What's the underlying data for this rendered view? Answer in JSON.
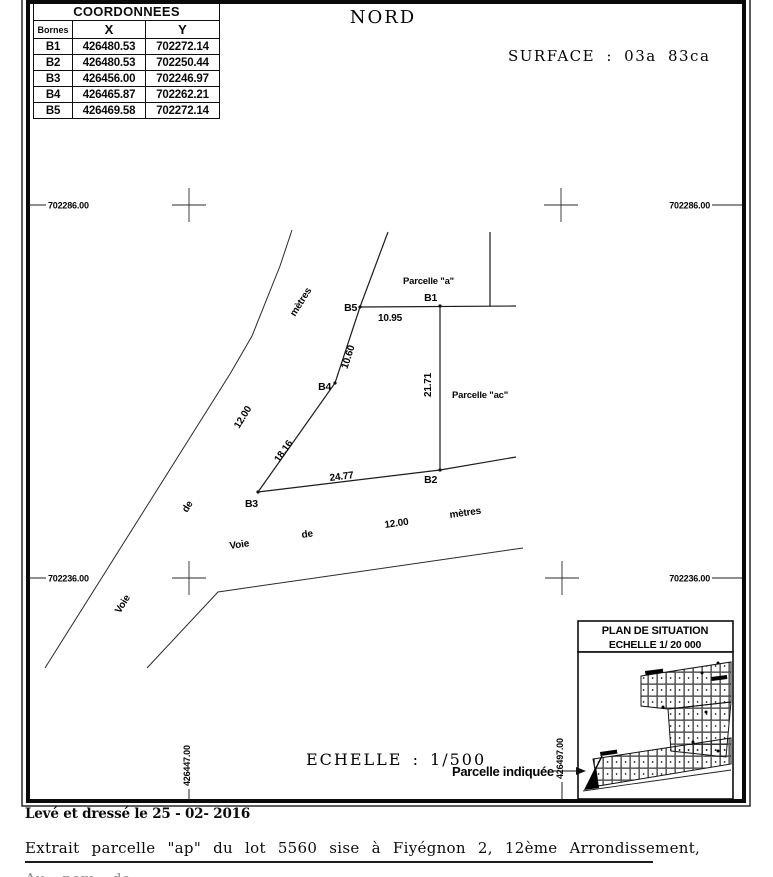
{
  "document": {
    "north_label": "NORD",
    "surface_label": "SURFACE : 03a 83ca",
    "scale_label": "ECHELLE : 1/500"
  },
  "coordinates_table": {
    "title": "COORDONNEES",
    "columns": [
      "Bornes",
      "X",
      "Y"
    ],
    "rows": [
      {
        "borne": "B1",
        "x": "426480.53",
        "y": "702272.14"
      },
      {
        "borne": "B2",
        "x": "426480.53",
        "y": "702250.44"
      },
      {
        "borne": "B3",
        "x": "426456.00",
        "y": "702246.97"
      },
      {
        "borne": "B4",
        "x": "426465.87",
        "y": "702262.21"
      },
      {
        "borne": "B5",
        "x": "426469.58",
        "y": "702272.14"
      }
    ]
  },
  "grid": {
    "north_y": "702286.00",
    "south_y": "702236.00",
    "west_x": "426447.00",
    "east_x": "426497.00"
  },
  "parcel": {
    "bornes": [
      "B1",
      "B2",
      "B3",
      "B4",
      "B5"
    ],
    "names": {
      "a": "Parcelle \"a\"",
      "ac": "Parcelle \"ac\""
    },
    "dimensions": {
      "b5_b1": "10.95",
      "b1_b2": "21.71",
      "b3_b2": "24.77",
      "b3_b4": "18.16",
      "b4_b5": "10.60"
    }
  },
  "roads": {
    "diagonal": [
      "Voie",
      "de",
      "12.00",
      "mètres"
    ],
    "horizontal": [
      "Voie",
      "de",
      "12.00",
      "mètres"
    ]
  },
  "inset": {
    "title": "PLAN DE SITUATION",
    "scale": "ECHELLE 1/ 20 000",
    "pointer_label": "Parcelle indiquée"
  },
  "footer": {
    "surveyed": "Levé et dressé le 25 - 02- 2016",
    "extract": "Extrait parcelle \"ap\" du lot 5560 sise à Fiyégnon 2, 12ème Arrondissement,",
    "cut_line": "Au nom de ......."
  }
}
